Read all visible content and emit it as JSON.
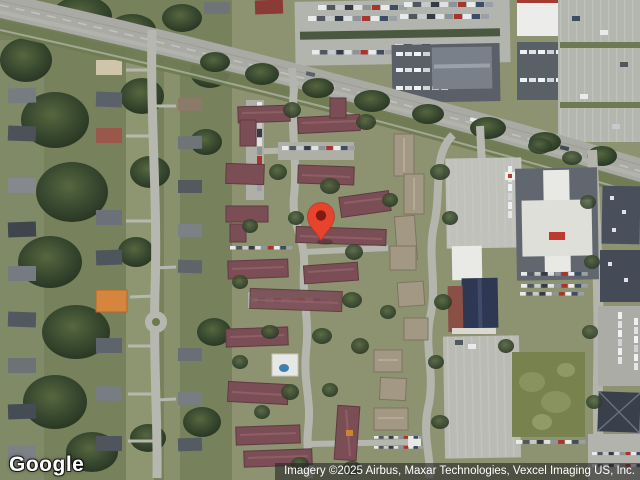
{
  "map": {
    "view_type": "satellite",
    "logo_text": "Google",
    "attribution_text": "Imagery ©2025 Airbus, Maxar Technologies, Vexcel Imaging US, Inc.",
    "marker": {
      "color": "#E8432D",
      "stroke_color": "#A32C20",
      "dot_color": "#7E1B12",
      "x": 321,
      "y": 241
    },
    "colors": {
      "tree_green": "#36452c",
      "grass": "#8d9371",
      "road": "#a8aaa3",
      "apartment_roof": "#7b4e55",
      "tan_roof": "#a39883",
      "field_green": "#77824f",
      "attribution_bg": "rgba(38,38,38,0.62)"
    }
  }
}
